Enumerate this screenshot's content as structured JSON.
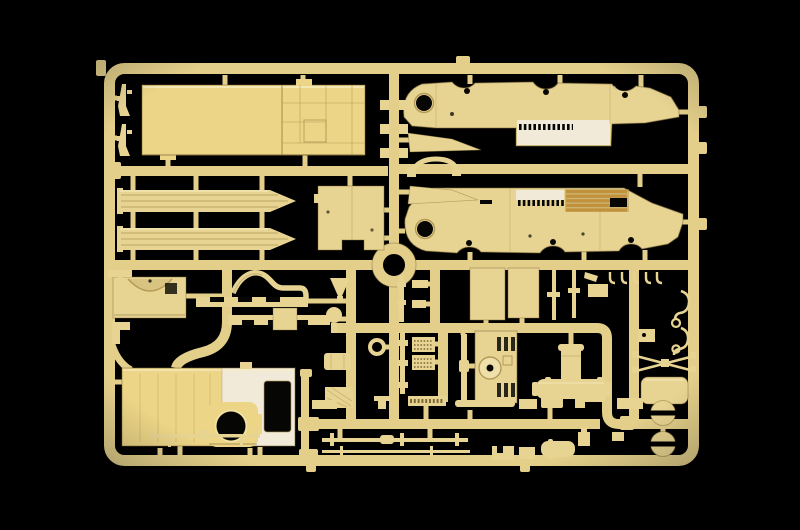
{
  "scene": {
    "kind": "photograph",
    "subject": "plastic-model-kit-sprue",
    "background": "black-studio",
    "plastic_finish": "cream-tan-polystyrene"
  },
  "palette": {
    "bg": "#000000",
    "runner": "#e3cf8a",
    "plastic": "#e8d492",
    "plastic_bright": "#ecd586",
    "plastic_light": "#f6ecc1",
    "plastic_shadow": "#b49a58",
    "plastic_deep": "#7e6a39",
    "white_lit": "#f1ead9",
    "gold": "#c2913b",
    "hole": "#060604"
  },
  "parts": [
    {
      "id": "sprue-frame",
      "count": 1
    },
    {
      "id": "center-ring",
      "count": 1
    },
    {
      "id": "cargo-bed-floor",
      "count": 1
    },
    {
      "id": "chassis-rail",
      "count": 2
    },
    {
      "id": "bulkhead-plate",
      "count": 1
    },
    {
      "id": "hull-side-panel",
      "count": 2
    },
    {
      "id": "louver-grille",
      "count": 1
    },
    {
      "id": "fender-wedge",
      "count": 2
    },
    {
      "id": "grab-handle",
      "count": 1
    },
    {
      "id": "firewall-arch",
      "count": 1
    },
    {
      "id": "exhaust-pipe",
      "count": 1
    },
    {
      "id": "ladder-strip",
      "count": 2
    },
    {
      "id": "cab-front-panel",
      "count": 1
    },
    {
      "id": "wheel-arch-ring",
      "count": 1
    },
    {
      "id": "door-panel",
      "count": 2
    },
    {
      "id": "radiator-block",
      "count": 1
    },
    {
      "id": "muffler-assembly",
      "count": 1
    },
    {
      "id": "mesh-plate",
      "count": 3
    },
    {
      "id": "rifle",
      "count": 2
    },
    {
      "id": "tow-hook",
      "count": 2
    },
    {
      "id": "crossed-rods",
      "count": 1
    },
    {
      "id": "base-plate",
      "count": 1
    },
    {
      "id": "idler-wheel",
      "count": 2
    },
    {
      "id": "axle-rod",
      "count": 3
    },
    {
      "id": "small-fittings",
      "count": 30
    }
  ]
}
